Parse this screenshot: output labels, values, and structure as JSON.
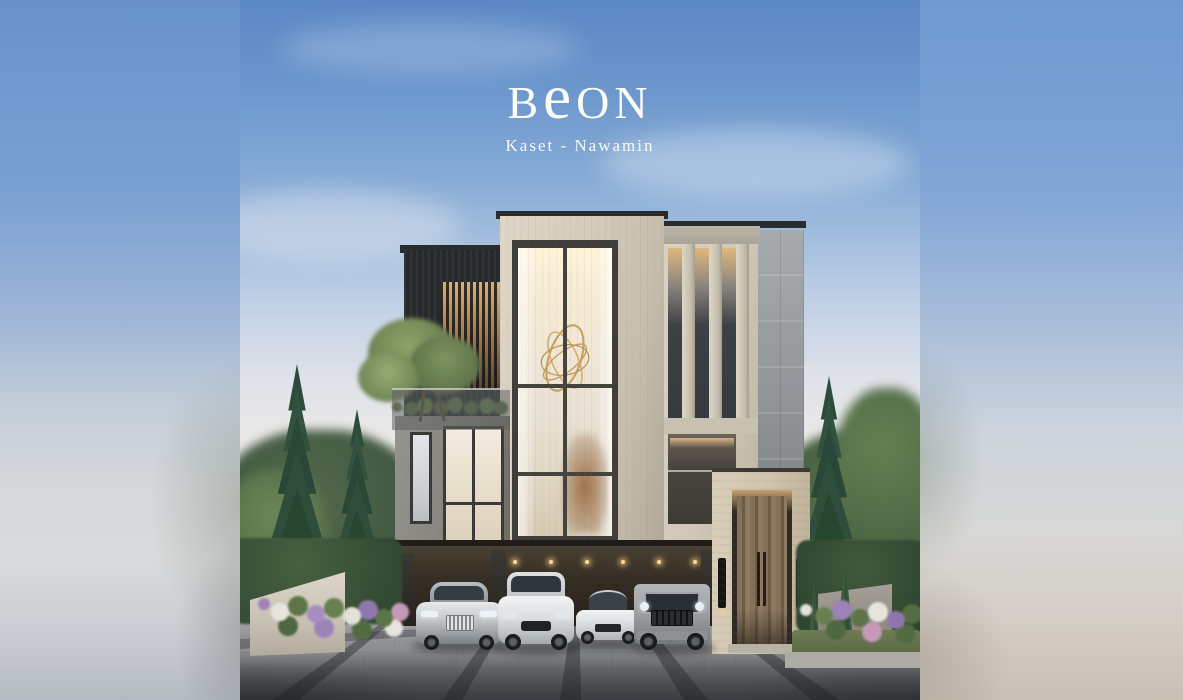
{
  "brand": {
    "logo": {
      "b": "B",
      "e": "e",
      "on": "ON",
      "full": "BeON"
    },
    "tagline": "Kaset - Nawamin"
  },
  "palette": {
    "sky_top": "#5b87c5",
    "sky_mid": "#c9d5e7",
    "sky_horizon": "#f2ede6",
    "side_panel_blue": "#6f99cf",
    "side_panel_light": "#d8dadc",
    "facade_cream": "#d5ccbd",
    "facade_charcoal": "#26292c",
    "facade_concrete": "#888680",
    "facade_stone_gray": "#92969a",
    "travertine_entrance": "#d0c4ad",
    "door_wood": "#7a6750",
    "interior_glow": "#f6ebd4",
    "foliage_dark": "#2e4d3a",
    "foliage_light": "#6c8756",
    "driveway_gray": "#9a9b9e",
    "asphalt_dark": "#4a4d51",
    "logo_text": "#fcfcf9"
  }
}
